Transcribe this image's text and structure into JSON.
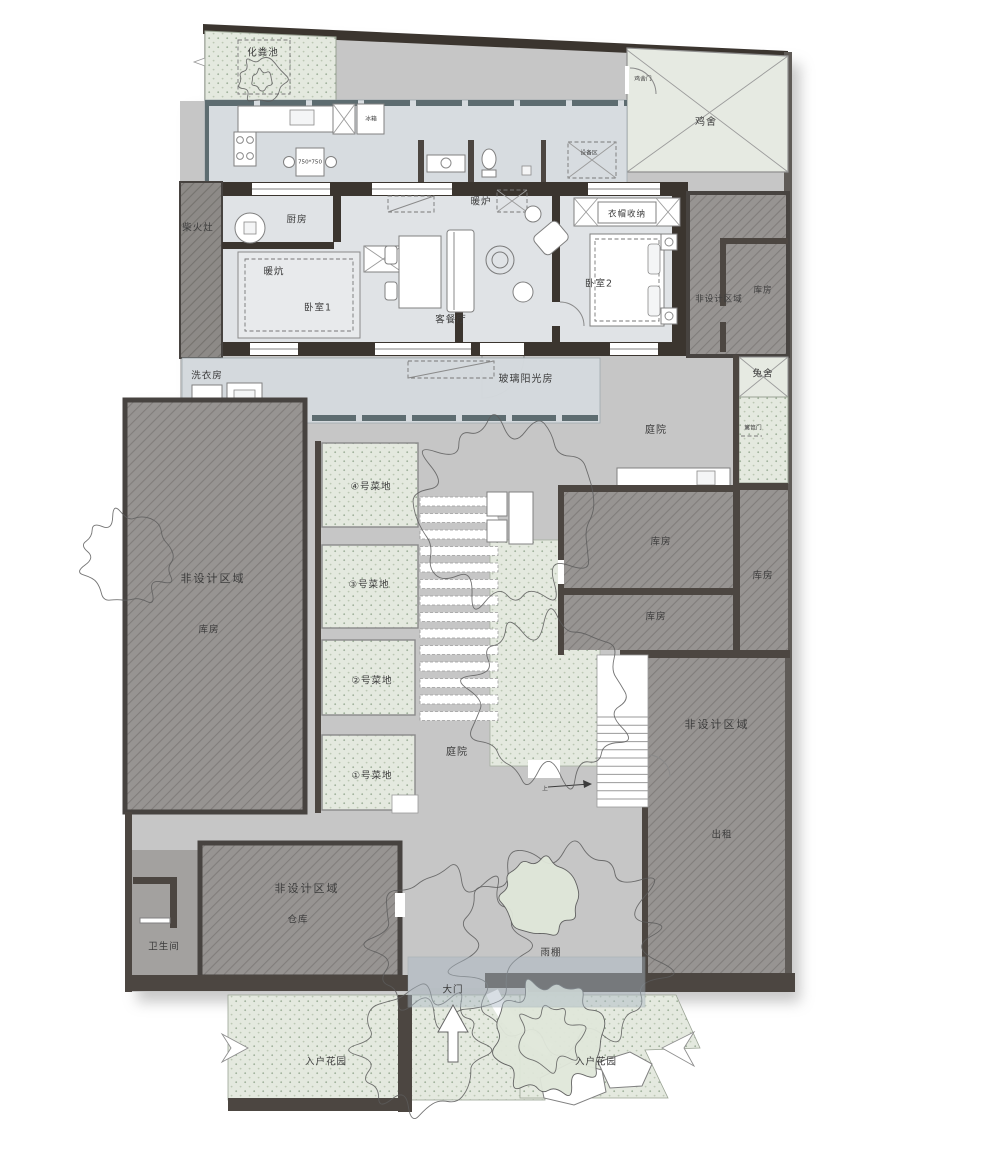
{
  "plan_type": "residential-floor-plan",
  "labels": {
    "septic_tank": "化粪池",
    "chicken_coop": "鸡舍",
    "chicken_gate": "鸡舍门",
    "equipment_zone": "设备区",
    "fridge": "冰箱",
    "table_size": "750*750",
    "wood_stove": "柴火灶",
    "kitchen": "厨房",
    "heater": "暖炉",
    "cloak_storage": "衣帽收纳",
    "kang": "暖炕",
    "bedroom1": "卧室1",
    "living_dining": "客餐厅",
    "bedroom2": "卧室2",
    "non_design_area": "非设计区域",
    "storeroom": "库房",
    "laundry": "洗衣房",
    "glass_sunroom": "玻璃阳光房",
    "rabbit_hutch": "兔舍",
    "fence_gate": "篱笆门",
    "courtyard": "庭院",
    "plot4": "④号菜地",
    "plot3": "③号菜地",
    "plot2": "②号菜地",
    "plot1": "①号菜地",
    "rent": "出租",
    "warehouse": "仓库",
    "bathroom": "卫生间",
    "rain_canopy": "雨棚",
    "main_gate": "大门",
    "entry_garden": "入户花园",
    "stairs_up": "上"
  },
  "colors": {
    "wall_dark": "#3b352f",
    "site_gray": "#c6c6c6",
    "non_design_hatch": "#979492",
    "garden_green": "#e4e9df",
    "glass_blue": "#d6dbdf",
    "interior_floor": "#e0e3e6",
    "canopy_overlay": "#aab8c4"
  }
}
